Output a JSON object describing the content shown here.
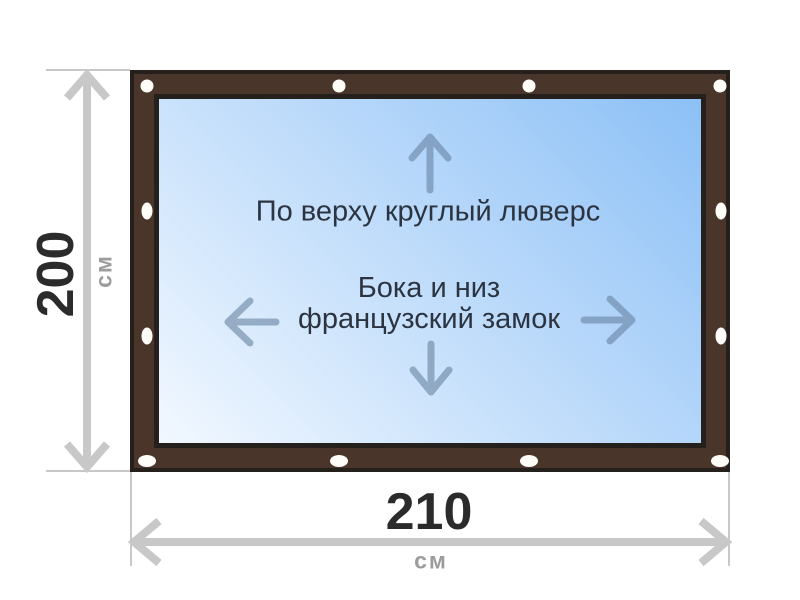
{
  "product": {
    "top_edge_label": "По верху круглый люверс",
    "sides_label_line1": "Бока и низ",
    "sides_label_line2": "французский замок"
  },
  "dimensions": {
    "height_value": "200",
    "height_unit": "см",
    "width_value": "210",
    "width_unit": "см"
  },
  "icons": {
    "up_arrow": "arrow-up-icon",
    "down_arrow": "arrow-down-icon",
    "left_arrow": "arrow-left-icon",
    "right_arrow": "arrow-right-icon",
    "grommet_count": 12
  },
  "colors": {
    "frame_brown": "#49352a",
    "frame_outline": "#26201d",
    "canvas_gradient_start": "#f2f8ff",
    "canvas_gradient_end": "#8cc0f6",
    "label_text": "#2b3440",
    "direction_arrow": "rgba(104,130,160,0.6)",
    "dimension_line": "#c8c8c8",
    "dimension_value": "#2b2b2b",
    "dimension_unit": "#9c9c9c",
    "grommet": "#fffdf8"
  }
}
